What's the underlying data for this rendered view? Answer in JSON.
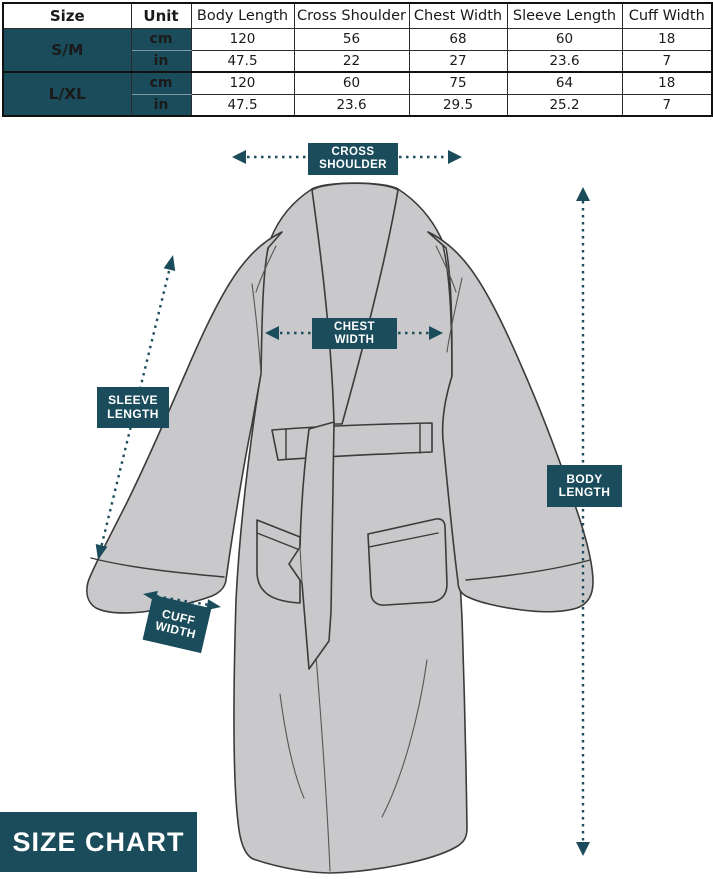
{
  "colors": {
    "teal": "#1A4C5C",
    "robe_fill": "#C9C9CB",
    "robe_outline": "#3B3B3B"
  },
  "size_table": {
    "headers": [
      "Size",
      "Unit",
      "Body Length",
      "Cross Shoulder",
      "Chest Width",
      "Sleeve Length",
      "Cuff Width"
    ],
    "groups": [
      {
        "size": "S/M",
        "rows": [
          {
            "unit": "cm",
            "values": [
              "120",
              "56",
              "68",
              "60",
              "18"
            ]
          },
          {
            "unit": "in",
            "values": [
              "47.5",
              "22",
              "27",
              "23.6",
              "7"
            ]
          }
        ]
      },
      {
        "size": "L/XL",
        "rows": [
          {
            "unit": "cm",
            "values": [
              "120",
              "60",
              "75",
              "64",
              "18"
            ]
          },
          {
            "unit": "in",
            "values": [
              "47.5",
              "23.6",
              "29.5",
              "25.2",
              "7"
            ]
          }
        ]
      }
    ]
  },
  "diagram": {
    "labels": {
      "cross_shoulder": {
        "line1": "CROSS",
        "line2": "SHOULDER"
      },
      "chest_width": {
        "line1": "CHEST",
        "line2": "WIDTH"
      },
      "sleeve_length": {
        "line1": "SLEEVE",
        "line2": "LENGTH"
      },
      "body_length": {
        "line1": "BODY",
        "line2": "LENGTH"
      },
      "cuff_width": {
        "line1": "CUFF",
        "line2": "WIDTH"
      }
    },
    "caption": "SIZE CHART"
  }
}
